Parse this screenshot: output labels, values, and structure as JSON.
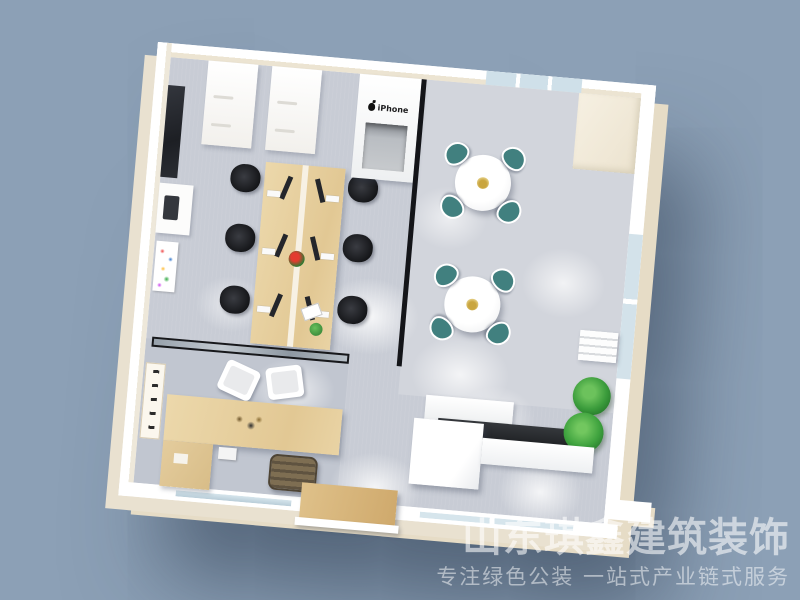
{
  "scene": {
    "description": "Top-down 3D render of a small office interior floor plan",
    "background_color": "#8CA0B6"
  },
  "watermark": {
    "line1": "山东琪鑫建筑装饰",
    "line2": "专注绿色公装  一站式产业链式服务"
  },
  "signs": {
    "apple_counter_label": "iPhone"
  },
  "palette": {
    "background": "#8CA0B6",
    "wall_top": "#FFFFFF",
    "wall_outer_face": "#E6DCC6",
    "wall_inner_face": "#ECE4D2",
    "floor": "#C8CCD5",
    "wood_desk": "#E6D0A3",
    "teal_chair": "#41807F",
    "black_chair": "#1E2024",
    "glass": "#CFE0E9",
    "dark_counter": "#2A2C30",
    "plant_green": "#3EA23E",
    "plant_gold": "#C9A53F"
  },
  "rooms": [
    {
      "name": "open-office",
      "items": [
        "wall blackboard",
        "two white storage cabinets",
        "printer stand",
        "abstract art poster",
        "6-seat wood workstation with monitors",
        "6 black office chairs",
        "red desk plant",
        "green desk plant"
      ]
    },
    {
      "name": "apple-display-counter",
      "items": [
        "white counter with Apple iPhone signage",
        "gray recessed niche"
      ]
    },
    {
      "name": "dining-break-area",
      "items": [
        "two round white tables",
        "8 teal wire chairs",
        "gold dried-flower centerpieces",
        "top window",
        "side window",
        "air conditioner",
        "window plant"
      ]
    },
    {
      "name": "executive-office",
      "items": [
        "black-framed glass partition",
        "calligraphy scroll",
        "wood executive desk",
        "two white guest chairs",
        "brown executive chair",
        "wood side cabinet"
      ]
    },
    {
      "name": "reception",
      "items": [
        "white back cabinet",
        "dark stone countertop",
        "white reception desk cube",
        "white counter arm",
        "potted plant"
      ]
    },
    {
      "name": "entrance",
      "items": [
        "wood shoe cabinet step",
        "white sill",
        "bottom windows"
      ]
    }
  ]
}
